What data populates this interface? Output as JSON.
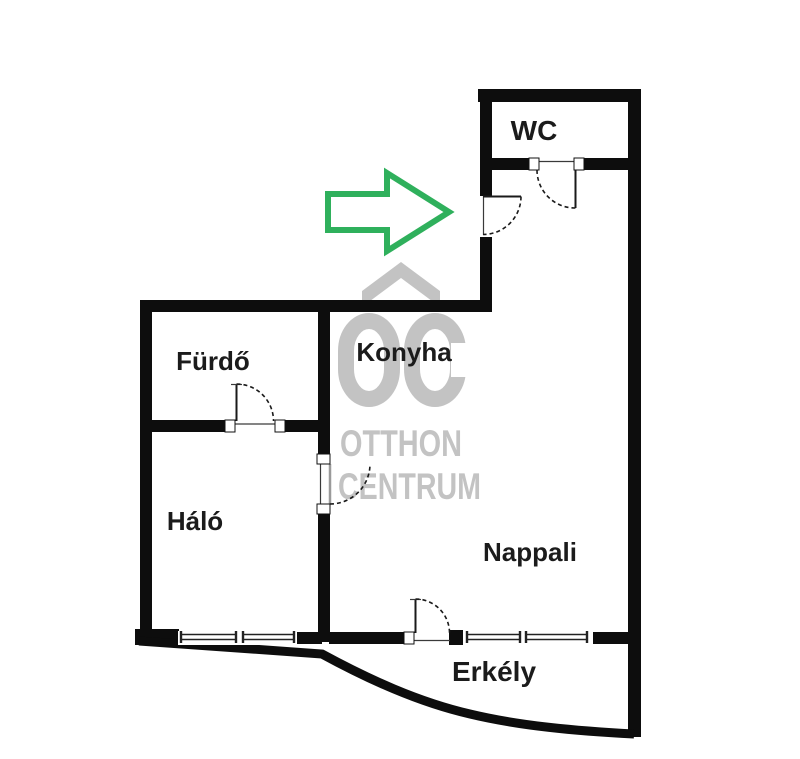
{
  "floorplan": {
    "rooms": [
      {
        "id": "wc",
        "label": "WC"
      },
      {
        "id": "furdo",
        "label": "Fürdő"
      },
      {
        "id": "konyha",
        "label": "Konyha"
      },
      {
        "id": "halo",
        "label": "Háló"
      },
      {
        "id": "nappali",
        "label": "Nappali"
      },
      {
        "id": "erkely",
        "label": "Erkély"
      }
    ],
    "entrance_arrow": {
      "icon": "arrow-right",
      "color": "#2fb05c"
    },
    "watermark": {
      "initials": "OC",
      "line1": "OTTHON",
      "line2": "CENTRUM",
      "color": "#c3c3c3"
    },
    "colors": {
      "wall": "#0d0d0d",
      "label_text": "#1b1b1b",
      "background": "#ffffff"
    }
  }
}
